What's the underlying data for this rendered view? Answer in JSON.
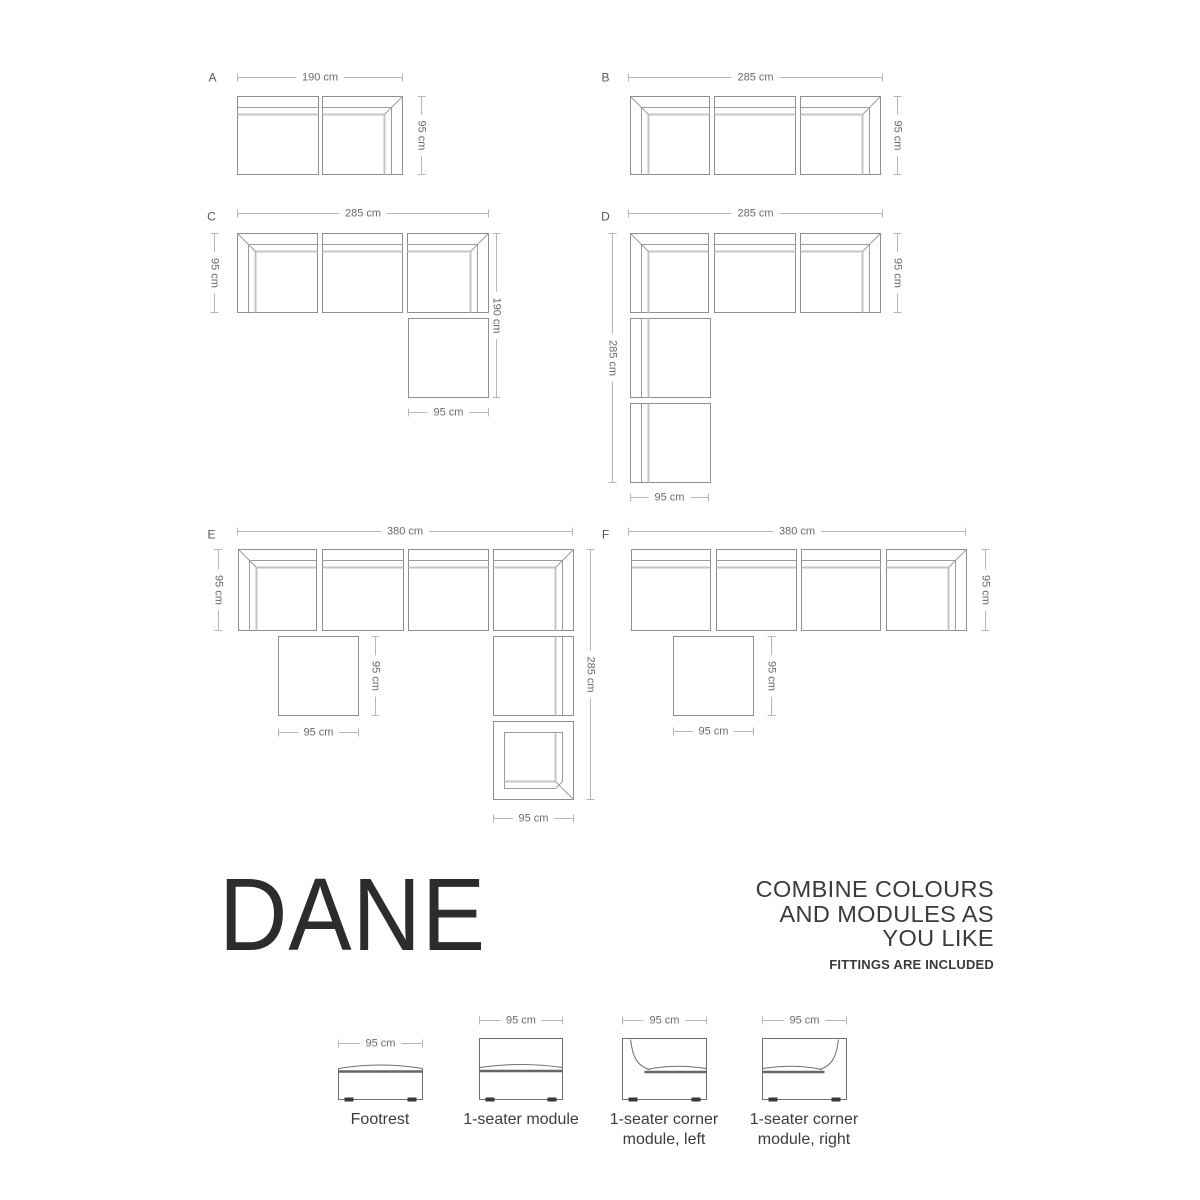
{
  "title": "DANE",
  "tagline": "COMBINE COLOURS\nAND MODULES AS\nYOU LIKE",
  "fittings_note": "FITTINGS ARE INCLUDED",
  "colors": {
    "module_outline": "#8f8f8f",
    "back_line_dark": "#9c9c9c",
    "back_line_light": "#c4c4c4",
    "dim_line": "#b6b6b6",
    "dim_text": "#6a6a6a",
    "letter_text": "#565656",
    "legend_stroke": "#6f6f6f",
    "legend_band": "#666666",
    "feet": "#383838",
    "title_text": "#2c2c2c"
  },
  "diagram": {
    "configs": [
      {
        "letter": "A",
        "letter_pos": [
          212,
          77
        ],
        "dims": [
          {
            "o": "h",
            "x1": 237,
            "x2": 402,
            "y": 77,
            "label": "190 cm"
          },
          {
            "o": "v",
            "x": 421,
            "y1": 96,
            "y2": 174,
            "label": "95 cm"
          }
        ],
        "modules": [
          {
            "type": "seat-t",
            "x": 237,
            "y": 96,
            "w": 81,
            "h": 78
          },
          {
            "type": "corner-tr",
            "x": 322,
            "y": 96,
            "w": 80,
            "h": 78
          }
        ]
      },
      {
        "letter": "B",
        "letter_pos": [
          605,
          77
        ],
        "dims": [
          {
            "o": "h",
            "x1": 628,
            "x2": 882,
            "y": 77,
            "label": "285 cm"
          },
          {
            "o": "v",
            "x": 897,
            "y1": 96,
            "y2": 174,
            "label": "95 cm"
          }
        ],
        "modules": [
          {
            "type": "corner-tl",
            "x": 630,
            "y": 96,
            "w": 79,
            "h": 78
          },
          {
            "type": "seat-t",
            "x": 714,
            "y": 96,
            "w": 81,
            "h": 78
          },
          {
            "type": "corner-tr",
            "x": 800,
            "y": 96,
            "w": 80,
            "h": 78
          }
        ]
      },
      {
        "letter": "C",
        "letter_pos": [
          211,
          216
        ],
        "dims": [
          {
            "o": "h",
            "x1": 237,
            "x2": 488,
            "y": 213,
            "label": "285 cm"
          },
          {
            "o": "v",
            "x": 214,
            "y1": 233,
            "y2": 312,
            "label": "95 cm"
          },
          {
            "o": "v",
            "x": 496,
            "y1": 233,
            "y2": 397,
            "label": "190 cm"
          },
          {
            "o": "h",
            "x1": 408,
            "x2": 488,
            "y": 412,
            "label": "95 cm"
          }
        ],
        "modules": [
          {
            "type": "corner-tl",
            "x": 237,
            "y": 233,
            "w": 80,
            "h": 79
          },
          {
            "type": "seat-t",
            "x": 322,
            "y": 233,
            "w": 80,
            "h": 79
          },
          {
            "type": "corner-tr",
            "x": 407,
            "y": 233,
            "w": 81,
            "h": 79
          },
          {
            "type": "footrest",
            "x": 408,
            "y": 318,
            "w": 80,
            "h": 79
          }
        ]
      },
      {
        "letter": "D",
        "letter_pos": [
          605,
          216
        ],
        "dims": [
          {
            "o": "h",
            "x1": 628,
            "x2": 882,
            "y": 213,
            "label": "285 cm"
          },
          {
            "o": "v",
            "x": 897,
            "y1": 233,
            "y2": 312,
            "label": "95 cm"
          },
          {
            "o": "v",
            "x": 612,
            "y1": 233,
            "y2": 482,
            "label": "285 cm"
          },
          {
            "o": "h",
            "x1": 630,
            "x2": 708,
            "y": 497,
            "label": "95 cm"
          }
        ],
        "modules": [
          {
            "type": "corner-tl",
            "x": 630,
            "y": 233,
            "w": 78,
            "h": 79
          },
          {
            "type": "seat-t",
            "x": 714,
            "y": 233,
            "w": 81,
            "h": 79
          },
          {
            "type": "corner-tr",
            "x": 800,
            "y": 233,
            "w": 80,
            "h": 79
          },
          {
            "type": "seat-l",
            "x": 630,
            "y": 318,
            "w": 80,
            "h": 79
          },
          {
            "type": "seat-l",
            "x": 630,
            "y": 403,
            "w": 80,
            "h": 79
          }
        ]
      },
      {
        "letter": "E",
        "letter_pos": [
          211,
          534
        ],
        "dims": [
          {
            "o": "h",
            "x1": 237,
            "x2": 572,
            "y": 531,
            "label": "380 cm"
          },
          {
            "o": "v",
            "x": 218,
            "y1": 549,
            "y2": 630,
            "label": "95 cm"
          },
          {
            "o": "v",
            "x": 375,
            "y1": 636,
            "y2": 715,
            "label": "95 cm"
          },
          {
            "o": "h",
            "x1": 278,
            "x2": 358,
            "y": 732,
            "label": "95 cm"
          },
          {
            "o": "v",
            "x": 590,
            "y1": 549,
            "y2": 799,
            "label": "285 cm"
          },
          {
            "o": "h",
            "x1": 493,
            "x2": 573,
            "y": 818,
            "label": "95 cm"
          }
        ],
        "modules": [
          {
            "type": "corner-tl",
            "x": 238,
            "y": 549,
            "w": 78,
            "h": 81
          },
          {
            "type": "seat-t",
            "x": 322,
            "y": 549,
            "w": 81,
            "h": 81
          },
          {
            "type": "seat-t",
            "x": 408,
            "y": 549,
            "w": 80,
            "h": 81
          },
          {
            "type": "corner-tr",
            "x": 493,
            "y": 549,
            "w": 80,
            "h": 81
          },
          {
            "type": "footrest",
            "x": 278,
            "y": 636,
            "w": 80,
            "h": 79
          },
          {
            "type": "seat-r",
            "x": 493,
            "y": 636,
            "w": 80,
            "h": 79
          },
          {
            "type": "corner-br",
            "x": 493,
            "y": 721,
            "w": 80,
            "h": 78
          }
        ]
      },
      {
        "letter": "F",
        "letter_pos": [
          605,
          534
        ],
        "dims": [
          {
            "o": "h",
            "x1": 628,
            "x2": 965,
            "y": 531,
            "label": "380 cm"
          },
          {
            "o": "v",
            "x": 985,
            "y1": 549,
            "y2": 630,
            "label": "95 cm"
          },
          {
            "o": "v",
            "x": 771,
            "y1": 636,
            "y2": 715,
            "label": "95 cm"
          },
          {
            "o": "h",
            "x1": 673,
            "x2": 753,
            "y": 731,
            "label": "95 cm"
          }
        ],
        "modules": [
          {
            "type": "seat-t",
            "x": 631,
            "y": 549,
            "w": 79,
            "h": 81
          },
          {
            "type": "seat-t",
            "x": 716,
            "y": 549,
            "w": 80,
            "h": 81
          },
          {
            "type": "seat-t",
            "x": 801,
            "y": 549,
            "w": 79,
            "h": 81
          },
          {
            "type": "corner-tr",
            "x": 886,
            "y": 549,
            "w": 80,
            "h": 81
          },
          {
            "type": "footrest",
            "x": 673,
            "y": 636,
            "w": 80,
            "h": 79
          }
        ]
      }
    ]
  },
  "legend": {
    "dim_label": "95 cm",
    "items": [
      {
        "type": "footrest",
        "label": "Footrest",
        "box": [
          338,
          1063,
          84,
          36
        ],
        "dim_y": 1043
      },
      {
        "type": "seater",
        "label": "1-seater module",
        "box": [
          479,
          1038,
          83,
          61
        ],
        "dim_y": 1020
      },
      {
        "type": "corner-left",
        "label": "1-seater corner\nmodule, left",
        "box": [
          622,
          1038,
          84,
          61
        ],
        "dim_y": 1020
      },
      {
        "type": "corner-right",
        "label": "1-seater corner\nmodule, right",
        "box": [
          762,
          1038,
          84,
          61
        ],
        "dim_y": 1020
      }
    ]
  }
}
